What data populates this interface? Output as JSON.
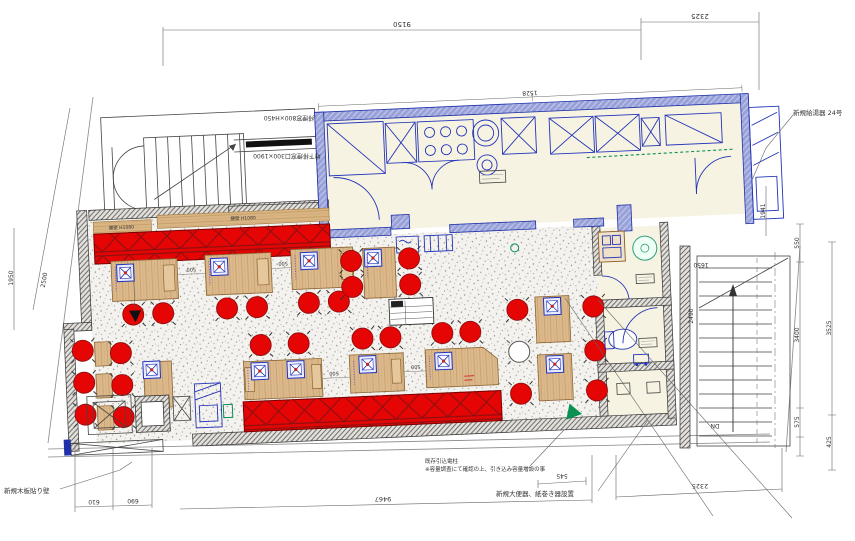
{
  "plan": {
    "ann": {
      "water_heater": "新規給湯器 24号",
      "smoke_window": "排煙窓800×H450",
      "underfloor_window": "地下排煙窓口300×1900",
      "wood_wall": "新規木板貼り壁",
      "power_pole1": "既存引込電柱",
      "power_pole2": "※容量調査にて確認の上、引き込み容量増設の事",
      "toilet_note": "新規大便器、紙巻き器設置",
      "stair_dn": "DN",
      "wainscot": "腰壁 H1080"
    },
    "dims": {
      "top_main": "9150",
      "top_right": "2325",
      "kitchen_width": "1528",
      "left_slope": "2500",
      "left_edge": "1950",
      "bottom_610": "610",
      "bottom_690": "690",
      "bottom_main": "9467",
      "bottom_right": "2325",
      "right_550": "550",
      "right_3400": "3400",
      "right_575": "575",
      "right_3525": "3525",
      "right_425": "425",
      "right_1941": "1941",
      "stair_2490": "2490",
      "stair_1650": "1650",
      "wc_545": "545",
      "gap_500": "500"
    }
  }
}
